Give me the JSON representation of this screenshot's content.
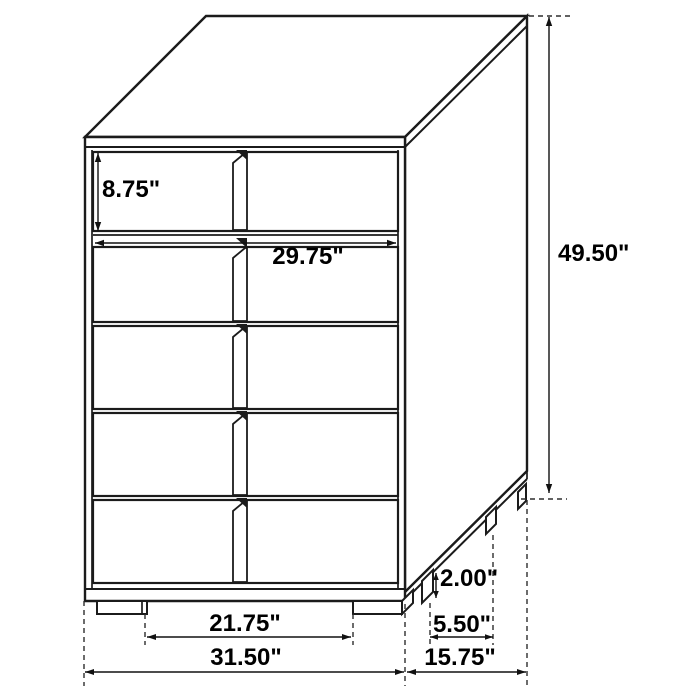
{
  "figure": {
    "type": "furniture-dimension-diagram",
    "subject": "5-drawer chest technical drawing",
    "background_color": "#ffffff",
    "line_color": "#1b1b1b",
    "text_color": "#000000"
  },
  "dims": {
    "top_drawer_height": "8.75\"",
    "drawer_width": "29.75\"",
    "overall_height": "49.50\"",
    "leg_height": "2.00\"",
    "side_leg_gap": "5.50\"",
    "front_leg_gap": "21.75\"",
    "overall_width": "31.50\"",
    "overall_depth": "15.75\""
  }
}
